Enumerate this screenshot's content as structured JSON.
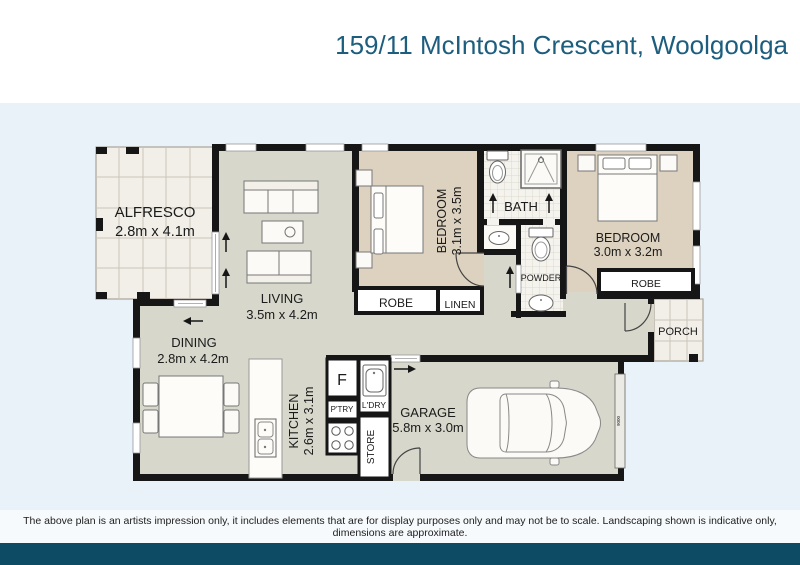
{
  "header": {
    "title": "159/11 McIntosh Crescent, Woolgoolga"
  },
  "plan": {
    "alfresco": {
      "name": "ALFRESCO",
      "dims": "2.8m x 4.1m"
    },
    "living": {
      "name": "LIVING",
      "dims": "3.5m x 4.2m"
    },
    "dining": {
      "name": "DINING",
      "dims": "2.8m x 4.2m"
    },
    "kitchen": {
      "name": "KITCHEN",
      "dims": "2.6m x 3.1m"
    },
    "garage": {
      "name": "GARAGE",
      "dims": "5.8m x 3.0m"
    },
    "bedroom1": {
      "name": "BEDROOM",
      "dims": "3.1m x 3.5m"
    },
    "bedroom2": {
      "name": "BEDROOM",
      "dims": "3.0m x 3.2m"
    },
    "bath": {
      "name": "BATH"
    },
    "powder": {
      "name": "POWDER"
    },
    "porch": {
      "name": "PORCH"
    },
    "robe1": {
      "name": "ROBE"
    },
    "linen": {
      "name": "LINEN"
    },
    "robe2": {
      "name": "ROBE"
    },
    "fridge": {
      "name": "F"
    },
    "pantry": {
      "name": "P'TRY"
    },
    "laundry": {
      "name": "L'DRY"
    },
    "store": {
      "name": "STORE"
    },
    "garage_door_width": "9000"
  },
  "footer": {
    "disclaimer": "The above plan is an artists impression only, it includes elements that are for display purposes only and may not be to scale. Landscaping shown is indicative only, dimensions are approximate."
  },
  "colors": {
    "background": "#e9f2f8",
    "title_text": "#1d5d7e",
    "footer_bar": "#0d4a63",
    "wall": "#161616",
    "floor_main": "#d7d7cb",
    "floor_bedroom": "#ddd2c0",
    "floor_outdoor": "#f2efe9"
  }
}
